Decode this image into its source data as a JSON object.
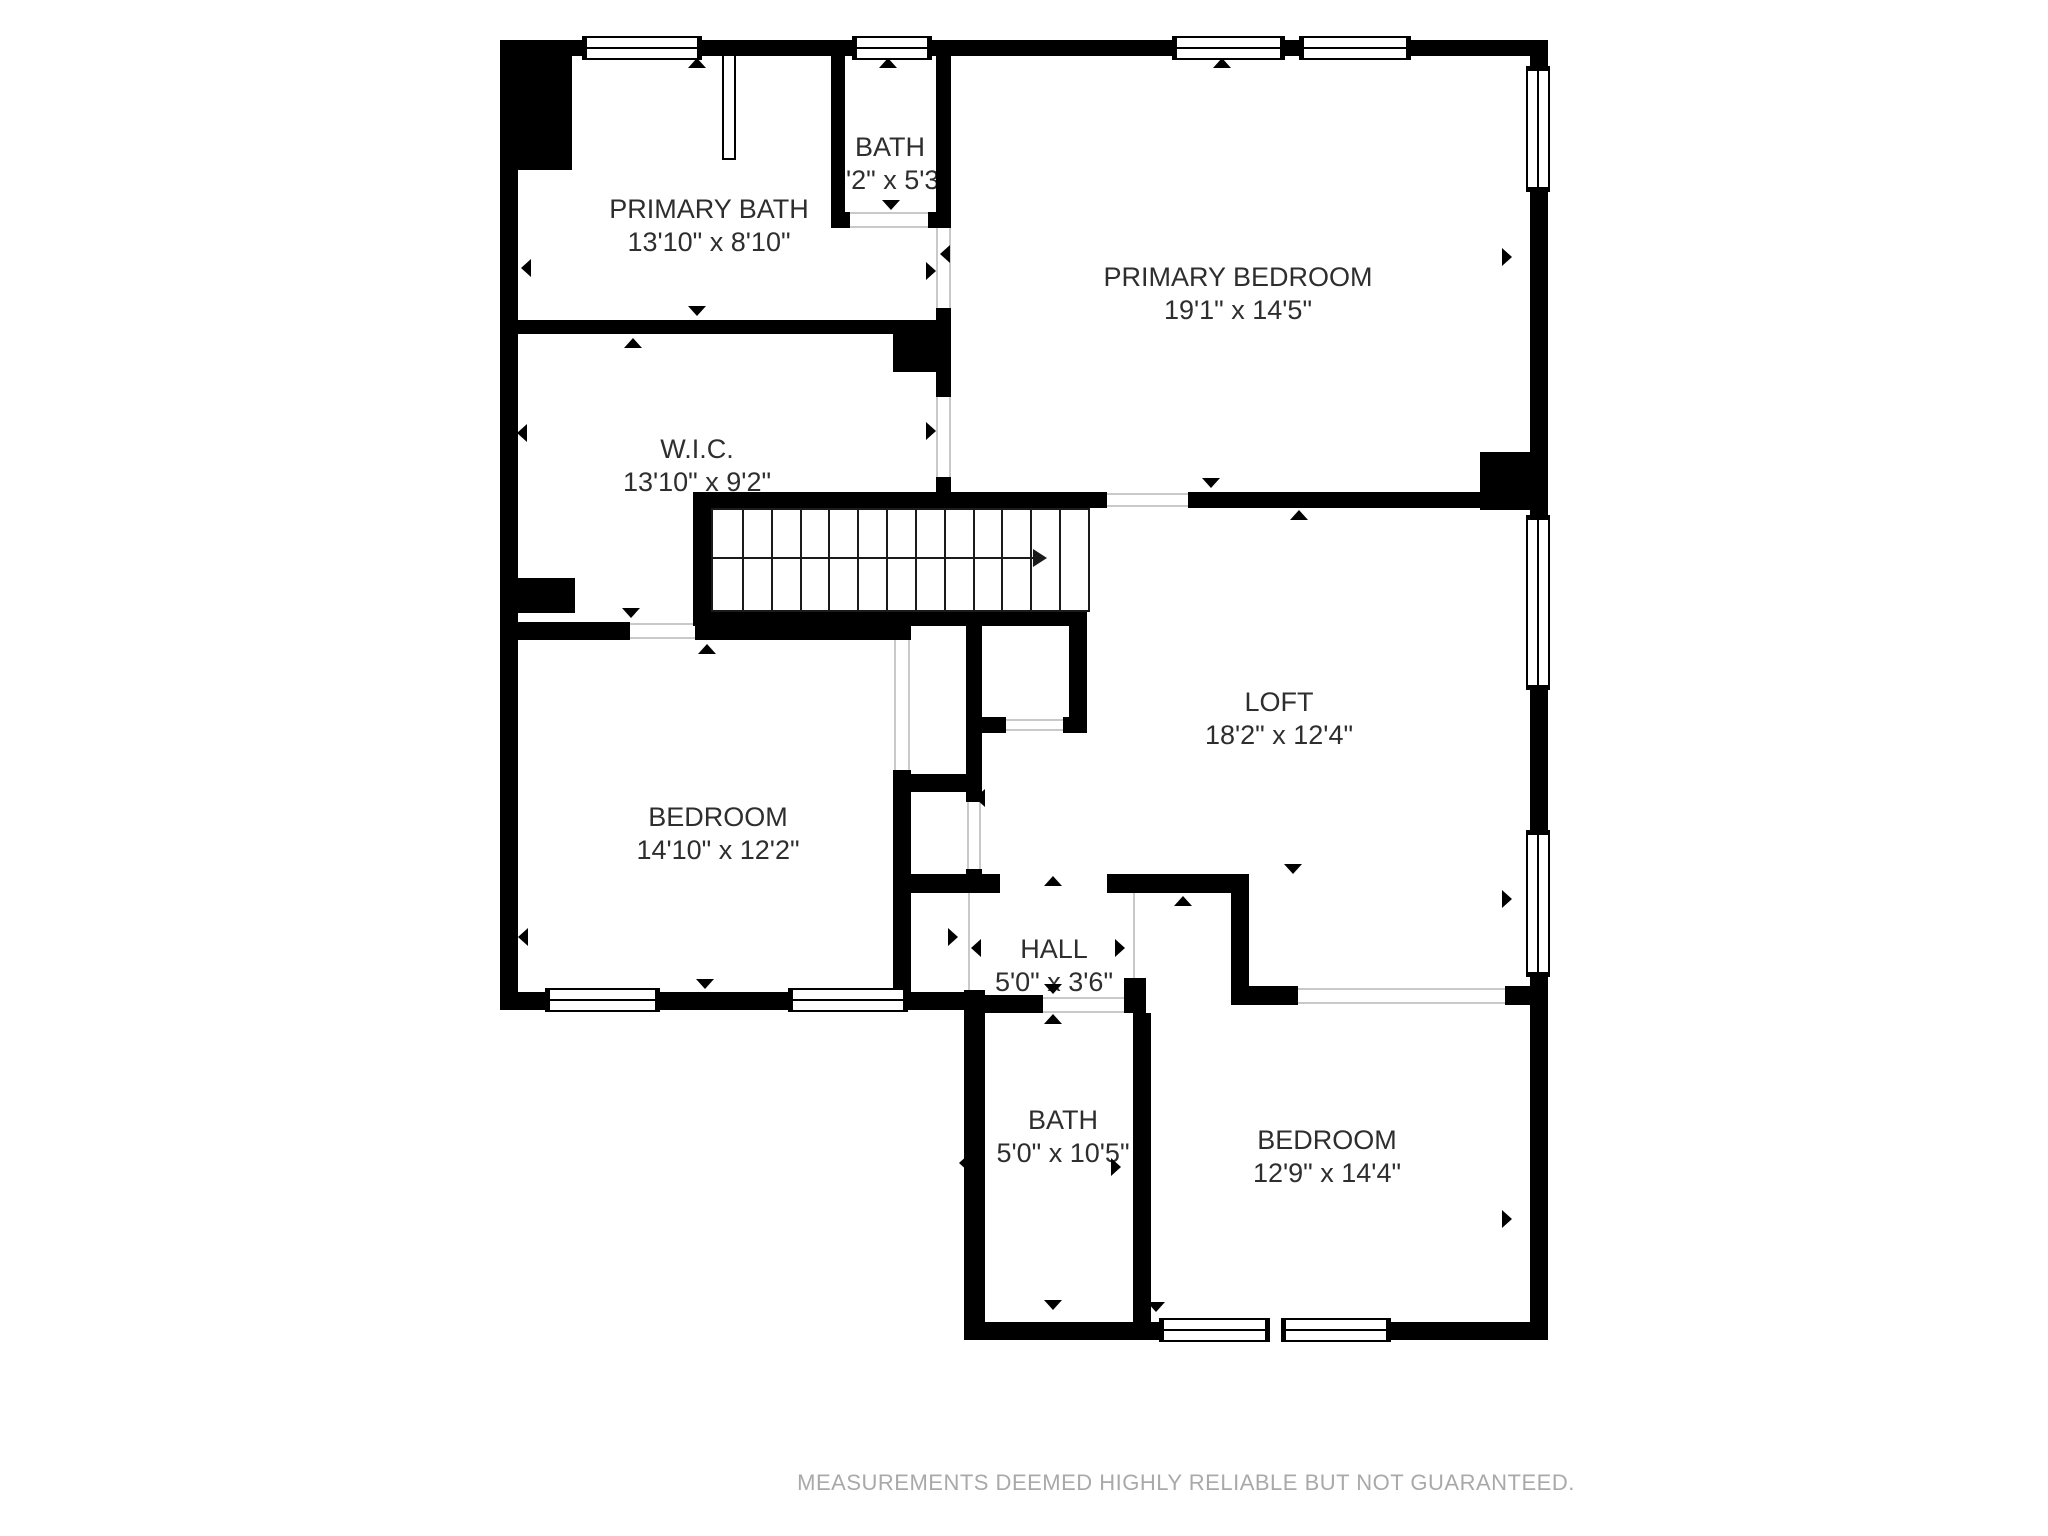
{
  "plan": {
    "rooms": {
      "primary_bath": {
        "name": "PRIMARY BATH",
        "dims": "13'10\" x 8'10\""
      },
      "bath_upper": {
        "name": "BATH",
        "dims": "3'2\" x 5'3\""
      },
      "primary_bedroom": {
        "name": "PRIMARY BEDROOM",
        "dims": "19'1\" x 14'5\""
      },
      "wic": {
        "name": "W.I.C.",
        "dims": "13'10\" x 9'2\""
      },
      "loft": {
        "name": "LOFT",
        "dims": "18'2\" x 12'4\""
      },
      "bedroom_left": {
        "name": "BEDROOM",
        "dims": "14'10\" x 12'2\""
      },
      "hall": {
        "name": "HALL",
        "dims": "5'0\" x 3'6\""
      },
      "bath_lower": {
        "name": "BATH",
        "dims": "5'0\" x 10'5\""
      },
      "bedroom_right": {
        "name": "BEDROOM",
        "dims": "12'9\" x 14'4\""
      }
    },
    "footer": "MEASUREMENTS DEEMED HIGHLY RELIABLE BUT NOT GUARANTEED.",
    "colors": {
      "wall": "#000000",
      "background": "#ffffff",
      "label": "#2e2e2e",
      "footer": "#a9a9a9"
    }
  }
}
